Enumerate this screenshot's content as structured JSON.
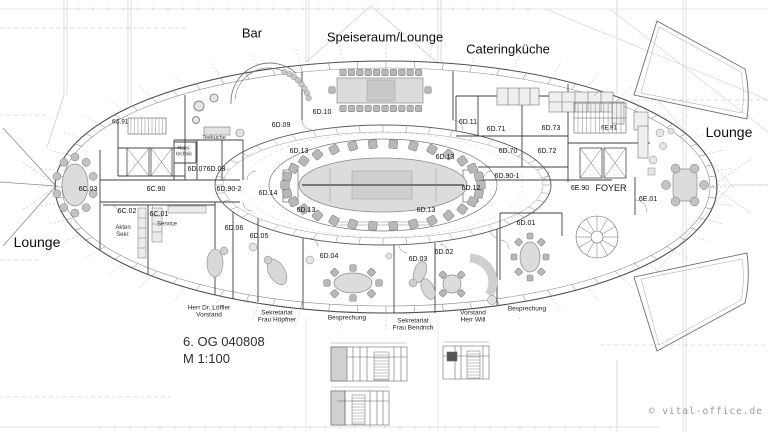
{
  "page": {
    "background": "#ffffff",
    "line_color": "#4a4a4a",
    "furniture_fill": "#d8d8d8"
  },
  "title_block": {
    "line1": "6. OG 040808",
    "line2": "M 1:100"
  },
  "watermark": {
    "text": "© vital-office.de"
  },
  "area_labels": [
    {
      "text": "Bar",
      "x": 252,
      "y": 34,
      "size": 13
    },
    {
      "text": "Speiseraum/Lounge",
      "x": 385,
      "y": 38,
      "size": 13
    },
    {
      "text": "Cateringküche",
      "x": 508,
      "y": 50,
      "size": 13
    },
    {
      "text": "Lounge",
      "x": 37,
      "y": 242,
      "size": 14
    },
    {
      "text": "Lounge",
      "x": 729,
      "y": 132,
      "size": 14
    }
  ],
  "room_labels": [
    {
      "text": "6C.91",
      "x": 120,
      "y": 123,
      "size": 6
    },
    {
      "text": "6C.03",
      "x": 88,
      "y": 190
    },
    {
      "text": "6C.90",
      "x": 156,
      "y": 190
    },
    {
      "text": "6C.02",
      "x": 127,
      "y": 212
    },
    {
      "text": "6C.01",
      "x": 159,
      "y": 215
    },
    {
      "text": "6D.07",
      "x": 197,
      "y": 170
    },
    {
      "text": "6D.08",
      "x": 216,
      "y": 170
    },
    {
      "text": "6D.90-2",
      "x": 229,
      "y": 190
    },
    {
      "text": "6D.09",
      "x": 281,
      "y": 126
    },
    {
      "text": "6D.10",
      "x": 322,
      "y": 113
    },
    {
      "text": "6D.14",
      "x": 268,
      "y": 194
    },
    {
      "text": "6D.13",
      "x": 299,
      "y": 152
    },
    {
      "text": "6D.13",
      "x": 445,
      "y": 158
    },
    {
      "text": "6D.13",
      "x": 306,
      "y": 211
    },
    {
      "text": "6D.13",
      "x": 426,
      "y": 211
    },
    {
      "text": "6D.12",
      "x": 471,
      "y": 189
    },
    {
      "text": "6D.11",
      "x": 468,
      "y": 123
    },
    {
      "text": "6D.71",
      "x": 496,
      "y": 130
    },
    {
      "text": "6D.73",
      "x": 551,
      "y": 129
    },
    {
      "text": "6D.70",
      "x": 508,
      "y": 152
    },
    {
      "text": "6D.72",
      "x": 547,
      "y": 152
    },
    {
      "text": "6D.90-1",
      "x": 507,
      "y": 177
    },
    {
      "text": "6E.91",
      "x": 609,
      "y": 129,
      "size": 6
    },
    {
      "text": "6E.90",
      "x": 580,
      "y": 189
    },
    {
      "text": "FOYER",
      "x": 611,
      "y": 188,
      "size": 9
    },
    {
      "text": "6E.01",
      "x": 648,
      "y": 200
    },
    {
      "text": "6D.06",
      "x": 234,
      "y": 229
    },
    {
      "text": "6D.05",
      "x": 259,
      "y": 237
    },
    {
      "text": "6D.04",
      "x": 329,
      "y": 257
    },
    {
      "text": "6D.03",
      "x": 418,
      "y": 260
    },
    {
      "text": "6D.02",
      "x": 444,
      "y": 253
    },
    {
      "text": "6D.01",
      "x": 526,
      "y": 224
    }
  ],
  "small_labels": [
    {
      "text": "Teeküche",
      "x": 214,
      "y": 138,
      "size": 5.5
    },
    {
      "text": "Haus-\ntechnik",
      "x": 184,
      "y": 152,
      "size": 5
    },
    {
      "text": "Akten\nSekr.",
      "x": 123,
      "y": 232,
      "size": 6
    },
    {
      "text": "Service",
      "x": 167,
      "y": 225,
      "size": 6
    }
  ],
  "annotations": [
    {
      "text": "Herr Dr. Löffler\nVorstand",
      "x": 209,
      "y": 312
    },
    {
      "text": "Sekretariat\nFrau Höpfner",
      "x": 277,
      "y": 317
    },
    {
      "text": "Besprechung",
      "x": 347,
      "y": 318
    },
    {
      "text": "Sekretariat\nFrau Bendrich",
      "x": 413,
      "y": 325
    },
    {
      "text": "Vorstand\nHerr Will",
      "x": 473,
      "y": 317
    },
    {
      "text": "Besprechung",
      "x": 527,
      "y": 309
    }
  ]
}
